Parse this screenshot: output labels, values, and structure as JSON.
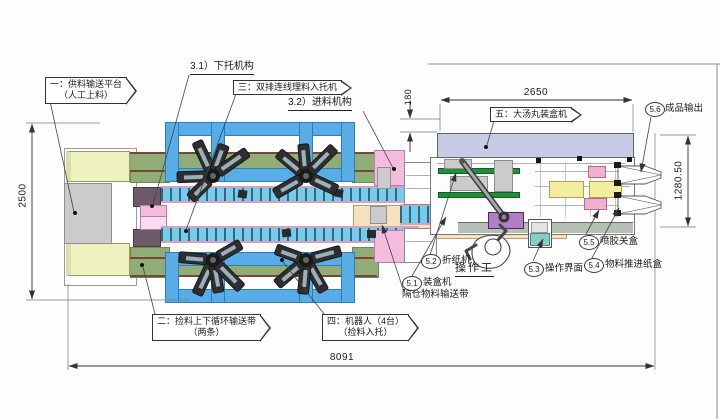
{
  "drawing": {
    "dimensions": {
      "overall_width": "2500",
      "overall_length": "8091",
      "cartoner_length": "2650",
      "cartoner_width": "1280.50",
      "offset": "180"
    },
    "callouts": {
      "feed_platform_line1": "一：供料输送平台",
      "feed_platform_line2": "（人工上料）",
      "tray_loader": "三：双排连线理料入托机",
      "cartoner": "五：大汤丸装盒机",
      "circulation_line1": "二：捡料上下循环输送带",
      "circulation_line2": "（两条）",
      "robots_line1": "四：机器人（4台）",
      "robots_line2": "（捡料入托）",
      "lower_tray_mech": "3.1）下托机构",
      "feed_mech": "3.2）进料机构",
      "operator": "操作工",
      "compartment_conveyor": "隔仓物料输送带",
      "n51_num": "5.1",
      "n51_text": "装盒机",
      "n52_num": "5.2",
      "n52_text": "折纸机",
      "n53_num": "5.3",
      "n53_text": "操作界面",
      "n54_num": "5.4",
      "n54_text": "物料推进纸盒",
      "n55_num": "5.5",
      "n55_text": "喷胶关盒",
      "n56_num": "5.6",
      "n56_text": "成品输出"
    },
    "colors": {
      "frame_blue": "#58ade7",
      "conveyor_green": "#90ad75",
      "platform_yellow": "#edf2c0",
      "belt_cell_blue": "#74cdec",
      "beige_conveyor": "#f4e2c0",
      "cartoner_lavender": "#c7cbe6",
      "folder_purple": "#b27fc7",
      "line_color": "#444444"
    }
  }
}
